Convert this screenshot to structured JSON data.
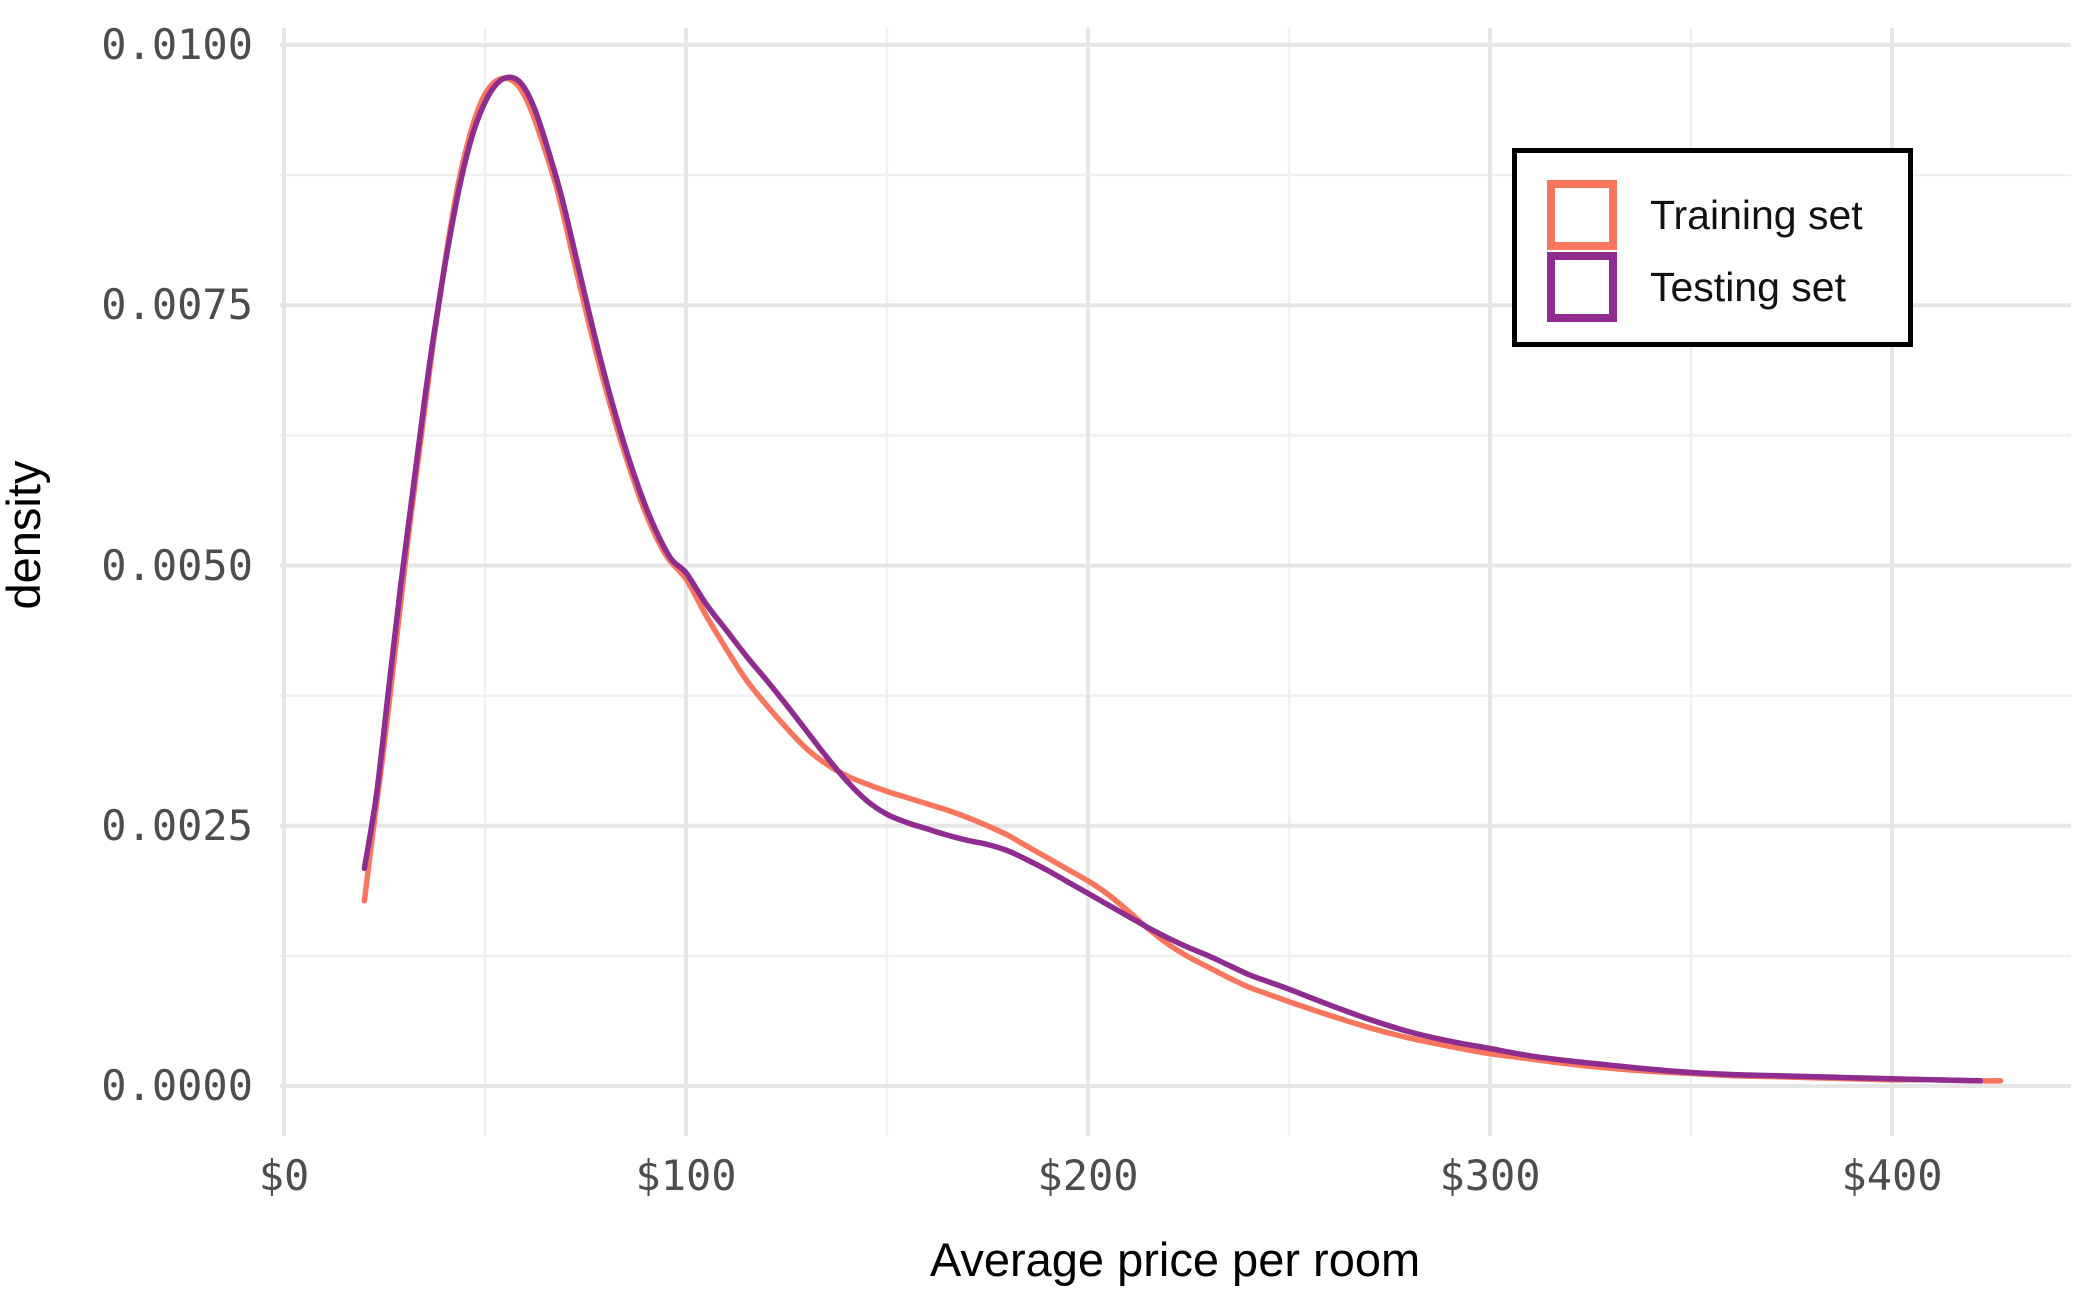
{
  "chart_data": {
    "type": "line",
    "subtype": "kernel-density",
    "title": "",
    "xlabel": "Average price per room",
    "ylabel": "density",
    "grid": true,
    "legend_position": "inside-top-right",
    "xlim": [
      -1,
      444
    ],
    "ylim": [
      -0.00048,
      0.01016
    ],
    "x_ticks": [
      {
        "value": 0,
        "label": "$0"
      },
      {
        "value": 100,
        "label": "$100"
      },
      {
        "value": 200,
        "label": "$200"
      },
      {
        "value": 300,
        "label": "$300"
      },
      {
        "value": 400,
        "label": "$400"
      }
    ],
    "y_ticks": [
      {
        "value": 0.0,
        "label": "0.0000"
      },
      {
        "value": 0.0025,
        "label": "0.0025"
      },
      {
        "value": 0.005,
        "label": "0.0050"
      },
      {
        "value": 0.0075,
        "label": "0.0075"
      },
      {
        "value": 0.01,
        "label": "0.0100"
      }
    ],
    "x_minor": [
      50,
      150,
      250,
      350
    ],
    "y_minor": [
      0.00125,
      0.00375,
      0.00625,
      0.00875
    ],
    "series": [
      {
        "name": "Training set",
        "color": "#F8765D",
        "points": [
          [
            20,
            0.00178
          ],
          [
            22,
            0.0024
          ],
          [
            25,
            0.0033
          ],
          [
            28,
            0.0043
          ],
          [
            31,
            0.0053
          ],
          [
            34,
            0.0062
          ],
          [
            37,
            0.0071
          ],
          [
            40,
            0.0079
          ],
          [
            43,
            0.0086
          ],
          [
            46,
            0.0091
          ],
          [
            49,
            0.00945
          ],
          [
            52,
            0.00963
          ],
          [
            55,
            0.00968
          ],
          [
            58,
            0.00962
          ],
          [
            61,
            0.00942
          ],
          [
            64,
            0.0091
          ],
          [
            68,
            0.0086
          ],
          [
            72,
            0.00795
          ],
          [
            76,
            0.0073
          ],
          [
            80,
            0.0067
          ],
          [
            85,
            0.00605
          ],
          [
            90,
            0.0055
          ],
          [
            95,
            0.0051
          ],
          [
            100,
            0.00487
          ],
          [
            105,
            0.00452
          ],
          [
            110,
            0.0042
          ],
          [
            115,
            0.0039
          ],
          [
            120,
            0.00366
          ],
          [
            125,
            0.00344
          ],
          [
            130,
            0.00324
          ],
          [
            135,
            0.00309
          ],
          [
            140,
            0.00298
          ],
          [
            145,
            0.0029
          ],
          [
            150,
            0.00283
          ],
          [
            155,
            0.00277
          ],
          [
            160,
            0.00271
          ],
          [
            165,
            0.00265
          ],
          [
            170,
            0.00258
          ],
          [
            175,
            0.0025
          ],
          [
            180,
            0.00241
          ],
          [
            185,
            0.0023
          ],
          [
            190,
            0.00219
          ],
          [
            195,
            0.00208
          ],
          [
            200,
            0.00197
          ],
          [
            205,
            0.00184
          ],
          [
            210,
            0.00168
          ],
          [
            215,
            0.00151
          ],
          [
            220,
            0.00136
          ],
          [
            225,
            0.00124
          ],
          [
            230,
            0.00114
          ],
          [
            235,
            0.00104
          ],
          [
            240,
            0.00095
          ],
          [
            245,
            0.00088
          ],
          [
            250,
            0.00081
          ],
          [
            260,
            0.00068
          ],
          [
            270,
            0.00056
          ],
          [
            280,
            0.00046
          ],
          [
            290,
            0.00038
          ],
          [
            300,
            0.00031
          ],
          [
            310,
            0.00026
          ],
          [
            320,
            0.00021
          ],
          [
            330,
            0.00017
          ],
          [
            340,
            0.00014
          ],
          [
            350,
            0.00012
          ],
          [
            360,
            0.0001
          ],
          [
            370,
            9e-05
          ],
          [
            380,
            8e-05
          ],
          [
            390,
            7e-05
          ],
          [
            400,
            6e-05
          ],
          [
            410,
            6e-05
          ],
          [
            420,
            5e-05
          ],
          [
            427,
            5e-05
          ]
        ]
      },
      {
        "name": "Testing set",
        "color": "#8E2C90",
        "points": [
          [
            20,
            0.00209
          ],
          [
            23,
            0.0028
          ],
          [
            26,
            0.0038
          ],
          [
            29,
            0.0048
          ],
          [
            32,
            0.0057
          ],
          [
            35,
            0.0066
          ],
          [
            38,
            0.0074
          ],
          [
            41,
            0.0081
          ],
          [
            44,
            0.0087
          ],
          [
            47,
            0.00915
          ],
          [
            50,
            0.00945
          ],
          [
            53,
            0.00963
          ],
          [
            56,
            0.00969
          ],
          [
            59,
            0.00963
          ],
          [
            62,
            0.00942
          ],
          [
            65,
            0.00908
          ],
          [
            69,
            0.00855
          ],
          [
            73,
            0.0079
          ],
          [
            77,
            0.00725
          ],
          [
            81,
            0.00665
          ],
          [
            86,
            0.006
          ],
          [
            91,
            0.00547
          ],
          [
            96,
            0.00508
          ],
          [
            100,
            0.00493
          ],
          [
            105,
            0.00463
          ],
          [
            110,
            0.00438
          ],
          [
            115,
            0.00413
          ],
          [
            120,
            0.0039
          ],
          [
            125,
            0.00366
          ],
          [
            130,
            0.00341
          ],
          [
            135,
            0.00316
          ],
          [
            140,
            0.00293
          ],
          [
            145,
            0.00274
          ],
          [
            150,
            0.00261
          ],
          [
            155,
            0.00253
          ],
          [
            160,
            0.00247
          ],
          [
            165,
            0.00241
          ],
          [
            170,
            0.00236
          ],
          [
            175,
            0.00232
          ],
          [
            180,
            0.00226
          ],
          [
            185,
            0.00217
          ],
          [
            190,
            0.00207
          ],
          [
            195,
            0.00196
          ],
          [
            200,
            0.00185
          ],
          [
            205,
            0.00174
          ],
          [
            210,
            0.00163
          ],
          [
            215,
            0.00152
          ],
          [
            220,
            0.00142
          ],
          [
            225,
            0.00133
          ],
          [
            230,
            0.00125
          ],
          [
            235,
            0.00116
          ],
          [
            240,
            0.00107
          ],
          [
            245,
            0.001
          ],
          [
            250,
            0.00093
          ],
          [
            260,
            0.00078
          ],
          [
            270,
            0.00064
          ],
          [
            280,
            0.00052
          ],
          [
            290,
            0.00043
          ],
          [
            300,
            0.00036
          ],
          [
            310,
            0.00029
          ],
          [
            320,
            0.00024
          ],
          [
            330,
            0.0002
          ],
          [
            340,
            0.00016
          ],
          [
            350,
            0.00013
          ],
          [
            360,
            0.00011
          ],
          [
            370,
            0.0001
          ],
          [
            380,
            9e-05
          ],
          [
            390,
            8e-05
          ],
          [
            400,
            7e-05
          ],
          [
            410,
            6e-05
          ],
          [
            422,
            5e-05
          ]
        ]
      }
    ]
  },
  "theme": {
    "background": "#ffffff",
    "grid_major_color": "#e6e6e6",
    "grid_minor_color": "#f0f0f0",
    "tick_label_color": "#4d4d4d",
    "axis_title_color": "#000000",
    "legend_border_color": "#000000",
    "legend_text_color": "#111111"
  }
}
